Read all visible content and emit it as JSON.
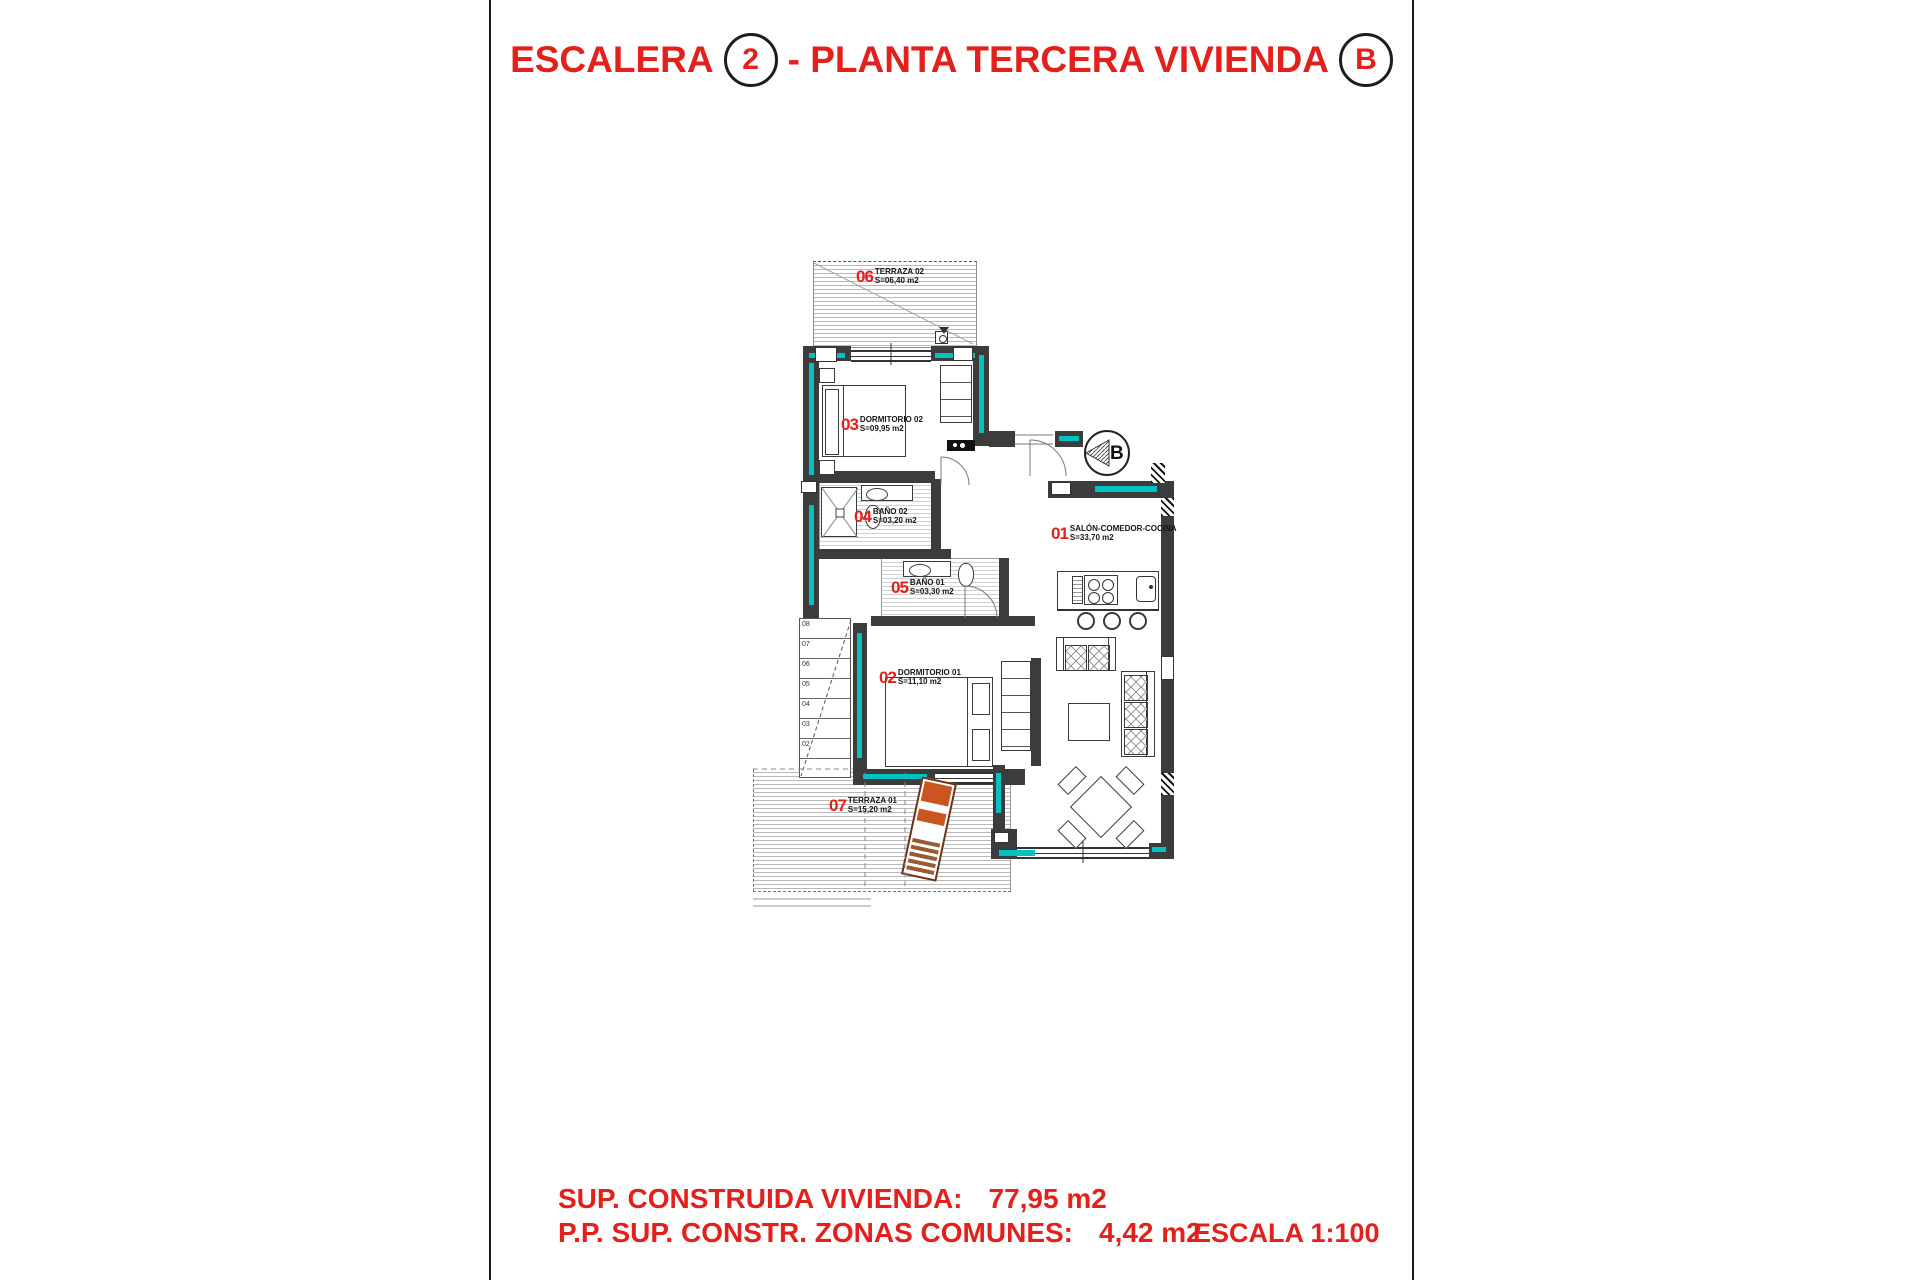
{
  "header": {
    "title_prefix": "ESCALERA",
    "stair_number": "2",
    "title_middle": "- PLANTA TERCERA VIVIENDA",
    "unit_letter": "B"
  },
  "plan": {
    "entrance_marker": "B",
    "rooms": [
      {
        "num": "06",
        "name": "TERRAZA 02",
        "area": "S=06,40 m2"
      },
      {
        "num": "03",
        "name": "DORMITORIO 02",
        "area": "S=09,95 m2"
      },
      {
        "num": "04",
        "name": "BAÑO 02",
        "area": "S=03,20 m2"
      },
      {
        "num": "05",
        "name": "BAÑO 01",
        "area": "S=03,30 m2"
      },
      {
        "num": "02",
        "name": "DORMITORIO 01",
        "area": "S=11,10 m2"
      },
      {
        "num": "01",
        "name": "SALÓN-COMEDOR-COCINA",
        "area": "S=33,70 m2"
      },
      {
        "num": "07",
        "name": "TERRAZA 01",
        "area": "S=15,20 m2"
      }
    ],
    "stair_numbers": [
      "08",
      "07",
      "06",
      "05",
      "04",
      "03",
      "02"
    ]
  },
  "footer": {
    "line1_label": "SUP. CONSTRUIDA VIVIENDA:",
    "line1_value": "77,95 m2",
    "line2_label": "P.P. SUP. CONSTR. ZONAS COMUNES:",
    "line2_value": "4,42 m2",
    "scale_text": "ESCALA 1:100"
  },
  "colors": {
    "accent_red": "#e3201b",
    "glazing_teal": "#00c2c2",
    "wall_dark": "#3c3c3c"
  }
}
